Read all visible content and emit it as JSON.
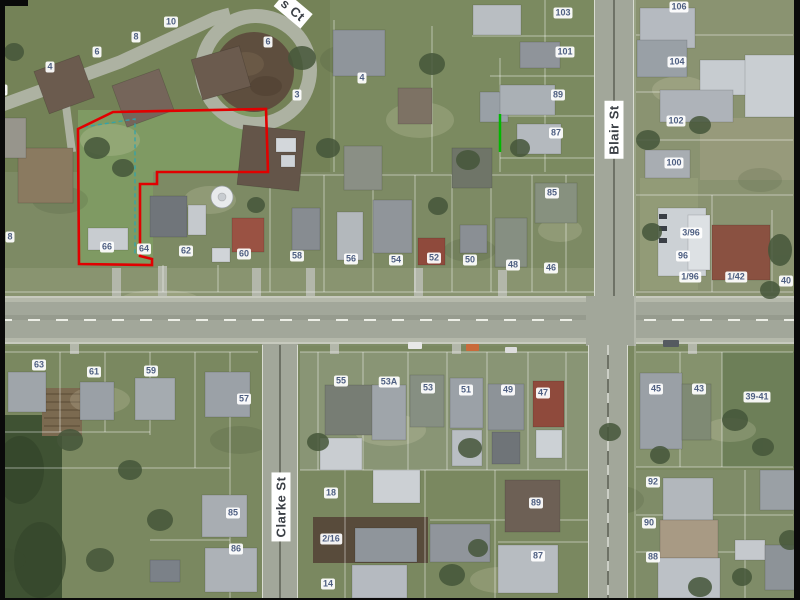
{
  "map": {
    "type": "aerial-photo-cadastral",
    "streets": {
      "blair": {
        "label": "Blair St"
      },
      "clarke": {
        "label": "Clarke St"
      },
      "court": {
        "label": "s Ct"
      }
    },
    "colors": {
      "parcel_boundary_red": "#e10000",
      "selection_teal": "#2fa3ad",
      "highlight_green": "#00b800",
      "label_text": "#4e5f82",
      "street_label_text": "#3b4046"
    },
    "house_numbers": [
      {
        "t": "2",
        "x": 3,
        "y": 90
      },
      {
        "t": "4",
        "x": 50,
        "y": 67
      },
      {
        "t": "6",
        "x": 97,
        "y": 52
      },
      {
        "t": "8",
        "x": 136,
        "y": 37
      },
      {
        "t": "10",
        "x": 171,
        "y": 22
      },
      {
        "t": "6",
        "x": 268,
        "y": 42
      },
      {
        "t": "4",
        "x": 362,
        "y": 78
      },
      {
        "t": "3",
        "x": 297,
        "y": 95
      },
      {
        "t": "103",
        "x": 563,
        "y": 13
      },
      {
        "t": "101",
        "x": 565,
        "y": 52
      },
      {
        "t": "89",
        "x": 558,
        "y": 95
      },
      {
        "t": "87",
        "x": 556,
        "y": 133
      },
      {
        "t": "85",
        "x": 552,
        "y": 193
      },
      {
        "t": "106",
        "x": 679,
        "y": 7
      },
      {
        "t": "104",
        "x": 677,
        "y": 62
      },
      {
        "t": "102",
        "x": 676,
        "y": 121
      },
      {
        "t": "100",
        "x": 674,
        "y": 163
      },
      {
        "t": "3/96",
        "x": 691,
        "y": 233
      },
      {
        "t": "96",
        "x": 683,
        "y": 256
      },
      {
        "t": "1/96",
        "x": 690,
        "y": 277
      },
      {
        "t": "1/42",
        "x": 736,
        "y": 277
      },
      {
        "t": "40",
        "x": 786,
        "y": 281
      },
      {
        "t": "8",
        "x": 10,
        "y": 237
      },
      {
        "t": "66",
        "x": 107,
        "y": 247
      },
      {
        "t": "64",
        "x": 144,
        "y": 249
      },
      {
        "t": "62",
        "x": 186,
        "y": 251
      },
      {
        "t": "60",
        "x": 244,
        "y": 254
      },
      {
        "t": "58",
        "x": 297,
        "y": 256
      },
      {
        "t": "56",
        "x": 351,
        "y": 259
      },
      {
        "t": "54",
        "x": 396,
        "y": 260
      },
      {
        "t": "52",
        "x": 434,
        "y": 258
      },
      {
        "t": "50",
        "x": 470,
        "y": 260
      },
      {
        "t": "48",
        "x": 513,
        "y": 265
      },
      {
        "t": "46",
        "x": 551,
        "y": 268
      },
      {
        "t": "63",
        "x": 39,
        "y": 365
      },
      {
        "t": "61",
        "x": 94,
        "y": 372
      },
      {
        "t": "59",
        "x": 151,
        "y": 371
      },
      {
        "t": "57",
        "x": 244,
        "y": 399
      },
      {
        "t": "55",
        "x": 341,
        "y": 381
      },
      {
        "t": "53A",
        "x": 389,
        "y": 382
      },
      {
        "t": "53",
        "x": 428,
        "y": 388
      },
      {
        "t": "51",
        "x": 466,
        "y": 390
      },
      {
        "t": "49",
        "x": 508,
        "y": 390
      },
      {
        "t": "47",
        "x": 543,
        "y": 393
      },
      {
        "t": "45",
        "x": 656,
        "y": 389
      },
      {
        "t": "43",
        "x": 699,
        "y": 389
      },
      {
        "t": "39-41",
        "x": 757,
        "y": 397
      },
      {
        "t": "85",
        "x": 233,
        "y": 513
      },
      {
        "t": "86",
        "x": 236,
        "y": 549
      },
      {
        "t": "18",
        "x": 331,
        "y": 493
      },
      {
        "t": "2/16",
        "x": 331,
        "y": 539
      },
      {
        "t": "14",
        "x": 328,
        "y": 584
      },
      {
        "t": "89",
        "x": 536,
        "y": 503
      },
      {
        "t": "87",
        "x": 538,
        "y": 556
      },
      {
        "t": "92",
        "x": 653,
        "y": 482
      },
      {
        "t": "90",
        "x": 649,
        "y": 523
      },
      {
        "t": "88",
        "x": 653,
        "y": 557
      }
    ]
  }
}
